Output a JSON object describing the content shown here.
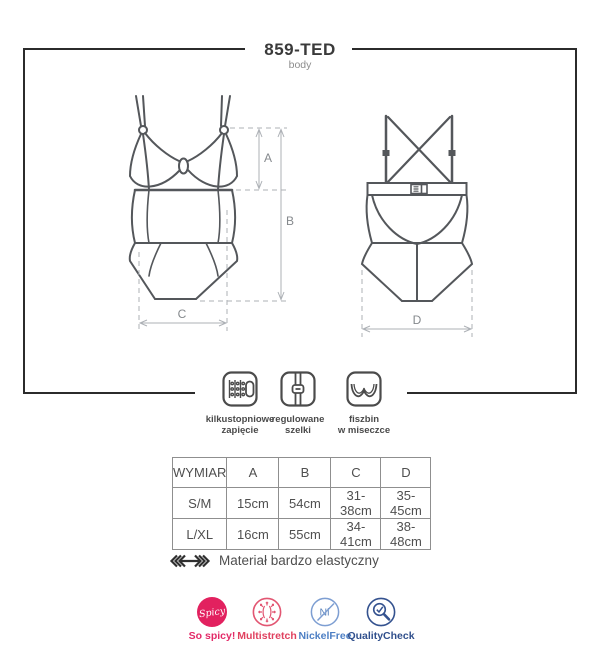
{
  "header": {
    "title": "859-TED",
    "subtitle": "body"
  },
  "diagram": {
    "dimension_labels": {
      "a": "A",
      "b": "B",
      "c": "C",
      "d": "D"
    }
  },
  "features": [
    {
      "line1": "kilkustopniowe",
      "line2": "zapięcie"
    },
    {
      "line1": "regulowane",
      "line2": "szelki"
    },
    {
      "line1": "fiszbin",
      "line2": "w miseczce"
    }
  ],
  "size_table": {
    "columns": [
      "WYMIAR",
      "A",
      "B",
      "C",
      "D"
    ],
    "rows": [
      [
        "S/M",
        "15cm",
        "54cm",
        "31-38cm",
        "35-45cm"
      ],
      [
        "L/XL",
        "16cm",
        "55cm",
        "34-41cm",
        "38-48cm"
      ]
    ]
  },
  "material_note": "Materiał bardzo elastyczny",
  "badges": [
    {
      "icon_text": "Spicy",
      "label": "So spicy!",
      "color": "#e2215f"
    },
    {
      "label": "Multistretch",
      "color": "#e0415f"
    },
    {
      "icon_text": "Ni",
      "label": "NickelFree",
      "color": "#4d7fc4"
    },
    {
      "label": "QualityCheck",
      "color": "#304f8c"
    }
  ]
}
